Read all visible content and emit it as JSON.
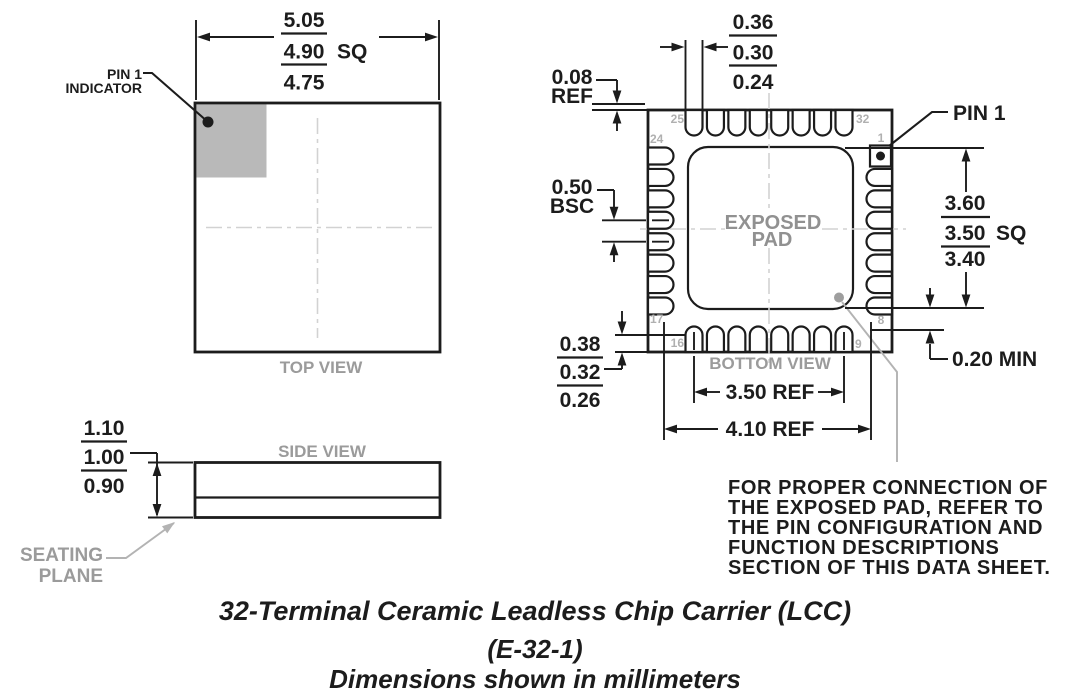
{
  "top_view": {
    "label": "TOP VIEW",
    "pin1_indicator": {
      "line1": "PIN 1",
      "line2": "INDICATOR"
    },
    "dim_body": {
      "max": "5.05",
      "nom": "4.90",
      "unit": "SQ",
      "min": "4.75"
    }
  },
  "side_view": {
    "label": "SIDE VIEW",
    "seating_plane": {
      "line1": "SEATING",
      "line2": "PLANE"
    },
    "dim_thickness": {
      "max": "1.10",
      "nom": "1.00",
      "min": "0.90"
    }
  },
  "bottom_view": {
    "label": "BOTTOM VIEW",
    "exposed_pad": {
      "line1": "EXPOSED",
      "line2": "PAD"
    },
    "pin1_label": "PIN 1",
    "pins": {
      "n1": "1",
      "n8": "8",
      "n9": "9",
      "n16": "16",
      "n17": "17",
      "n24": "24",
      "n25": "25",
      "n32": "32"
    },
    "dim_terminal_top": {
      "max": "0.36",
      "nom": "0.30",
      "min": "0.24"
    },
    "dim_edge_ref": {
      "value": "0.08",
      "suffix": "REF"
    },
    "dim_pitch": {
      "value": "0.50",
      "suffix": "BSC"
    },
    "dim_terminal_left": {
      "max": "0.38",
      "nom": "0.32",
      "min": "0.26"
    },
    "dim_exposed": {
      "max": "3.60",
      "nom": "3.50",
      "unit": "SQ",
      "min": "3.40"
    },
    "dim_gap_min": "0.20 MIN",
    "dim_pin_span": "3.50 REF",
    "dim_row_span": "4.10 REF"
  },
  "note": {
    "line1": "FOR PROPER CONNECTION OF",
    "line2": "THE EXPOSED PAD, REFER TO",
    "line3": "THE PIN CONFIGURATION AND",
    "line4": "FUNCTION DESCRIPTIONS",
    "line5": "SECTION OF THIS DATA SHEET."
  },
  "caption": {
    "line1": "32-Terminal Ceramic Leadless Chip Carrier (LCC)",
    "line2": "(E-32-1)",
    "line3": "Dimensions shown in millimeters"
  },
  "colors": {
    "line": "#1c1c1c",
    "gray_label": "#9b9b9b",
    "pin_number": "#b0b0b0",
    "centerline": "#d2d2d2",
    "indicator_fill": "#b9b9b9",
    "leader_gray": "#b3b3b3",
    "exposed_dot": "#9e9e9e"
  }
}
